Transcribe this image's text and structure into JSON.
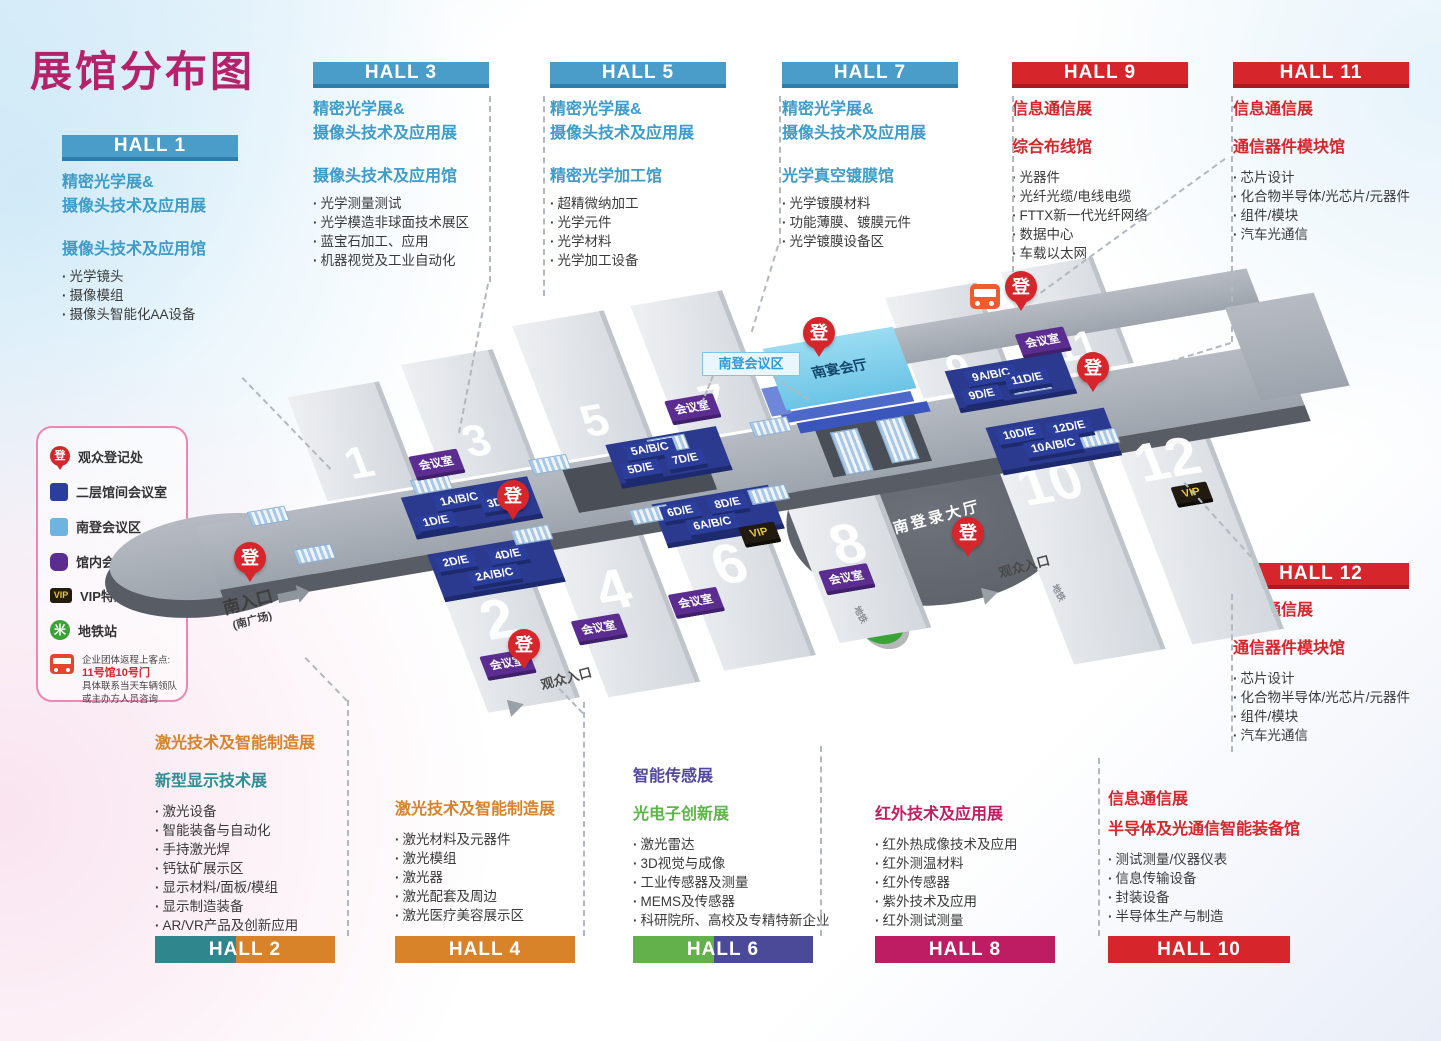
{
  "title": "展馆分布图",
  "legend": {
    "items": [
      {
        "icon": "registration-pin-icon",
        "label": "观众登记处"
      },
      {
        "icon": "dark-blue-square-icon",
        "label": "二层馆间会议室"
      },
      {
        "icon": "light-blue-square-icon",
        "label": "南登会议区"
      },
      {
        "icon": "purple-square-icon",
        "label": "馆内会议室"
      },
      {
        "icon": "vip-badge-icon",
        "label": "VIP特邀买家休息室"
      },
      {
        "icon": "metro-icon",
        "label": "地铁站"
      }
    ],
    "bus_note": {
      "line1": "企业团体返程上客点:",
      "line2": "11号馆10号门",
      "line3": "具体联系当天车辆领队",
      "line4": "或主办方人员咨询"
    }
  },
  "blocks": {
    "hall1": {
      "label": "HALL 1",
      "titles": [
        "精密光学展&",
        "摄像头技术及应用展"
      ],
      "section": "摄像头技术及应用馆",
      "items": [
        "光学镜头",
        "摄像模组",
        "摄像头智能化AA设备"
      ]
    },
    "hall3": {
      "label": "HALL 3",
      "titles": [
        "精密光学展&",
        "摄像头技术及应用展"
      ],
      "section": "摄像头技术及应用馆",
      "items": [
        "光学测量测试",
        "光学模造非球面技术展区",
        "蓝宝石加工、应用",
        "机器视觉及工业自动化"
      ]
    },
    "hall5": {
      "label": "HALL 5",
      "titles": [
        "精密光学展&",
        "摄像头技术及应用展"
      ],
      "section": "精密光学加工馆",
      "items": [
        "超精微纳加工",
        "光学元件",
        "光学材料",
        "光学加工设备"
      ]
    },
    "hall7": {
      "label": "HALL 7",
      "titles": [
        "精密光学展&",
        "摄像头技术及应用展"
      ],
      "section": "光学真空镀膜馆",
      "items": [
        "光学镀膜材料",
        "功能薄膜、镀膜元件",
        "光学镀膜设备区"
      ]
    },
    "hall9": {
      "label": "HALL 9",
      "titles": [
        "信息通信展",
        "综合布线馆"
      ],
      "items": [
        "光器件",
        "光纤光缆/电线电缆",
        "FTTX新一代光纤网络",
        "数据中心",
        "车载以太网"
      ]
    },
    "hall11": {
      "label": "HALL 11",
      "titles": [
        "信息通信展",
        "通信器件模块馆"
      ],
      "items": [
        "芯片设计",
        "化合物半导体/光芯片/元器件",
        "组件/模块",
        "汽车光通信"
      ]
    },
    "hall12": {
      "label": "HALL 12",
      "titles": [
        "信息通信展",
        "通信器件模块馆"
      ],
      "items": [
        "芯片设计",
        "化合物半导体/光芯片/元器件",
        "组件/模块",
        "汽车光通信"
      ]
    },
    "hall2": {
      "label": "HALL 2",
      "titles": [
        "激光技术及智能制造展",
        "新型显示技术展"
      ],
      "items": [
        "激光设备",
        "智能装备与自动化",
        "手持激光焊",
        "钙钛矿展示区",
        "显示材料/面板/模组",
        "显示制造装备",
        "AR/VR产品及创新应用"
      ]
    },
    "hall4": {
      "label": "HALL 4",
      "titles": [
        "激光技术及智能制造展"
      ],
      "items": [
        "激光材料及元器件",
        "激光模组",
        "激光器",
        "激光配套及周边",
        "激光医疗美容展示区"
      ]
    },
    "hall6": {
      "label": "HALL 6",
      "titles": [
        "智能传感展",
        "光电子创新展"
      ],
      "items": [
        "激光雷达",
        "3D视觉与成像",
        "工业传感器及测量",
        "MEMS及传感器",
        "科研院所、高校及专精特新企业"
      ]
    },
    "hall8": {
      "label": "HALL 8",
      "titles": [
        "红外技术及应用展"
      ],
      "items": [
        "红外热成像技术及应用",
        "红外测温材料",
        "红外传感器",
        "紫外技术及应用",
        "红外测试测量"
      ]
    },
    "hall10": {
      "label": "HALL 10",
      "titles": [
        "信息通信展",
        "半导体及光通信智能装备馆"
      ],
      "items": [
        "测试测量/仪器仪表",
        "信息传输设备",
        "封装设备",
        "半导体生产与制造"
      ]
    }
  },
  "map": {
    "hall_numbers": [
      "1",
      "2",
      "3",
      "4",
      "5",
      "6",
      "7",
      "8",
      "9",
      "10",
      "11",
      "12"
    ],
    "badges": [
      "1A/B/C",
      "3D/E",
      "1D/E",
      "5A/B/C",
      "5D/E",
      "7D/E",
      "2D/E",
      "4D/E",
      "2A/B/C",
      "6D/E",
      "8D/E",
      "6A/B/C",
      "9A/B/C",
      "9D/E",
      "11D/E",
      "10D/E",
      "12D/E",
      "10A/B/C"
    ],
    "meeting_room_label": "会议室",
    "vip_label": "VIP",
    "register_label": "登",
    "metro_glyph": "米",
    "labels": {
      "south_entrance": "南入口",
      "south_square": "(南广场)",
      "visitor_entrance": "观众入口",
      "south_reg_hall": "南登录大厅",
      "banquet_hall": "南宴会厅",
      "south_meeting_zone": "南登会议区",
      "metro": "地铁"
    }
  },
  "colors": {
    "title": "#b5216b",
    "blue": "#4a9dc9",
    "red": "#d6252b",
    "orange": "#d8832a",
    "teal": "#2f8f96",
    "purple": "#5149a0",
    "green": "#5cb648",
    "magenta": "#c01e62",
    "badge_blue": "#2c3e9b",
    "badge_purple": "#5c2d91",
    "vip_bg": "#201a10",
    "vip_text": "#e8c53a",
    "metro_green": "#3aa336",
    "pin_red": "#d6252b"
  }
}
